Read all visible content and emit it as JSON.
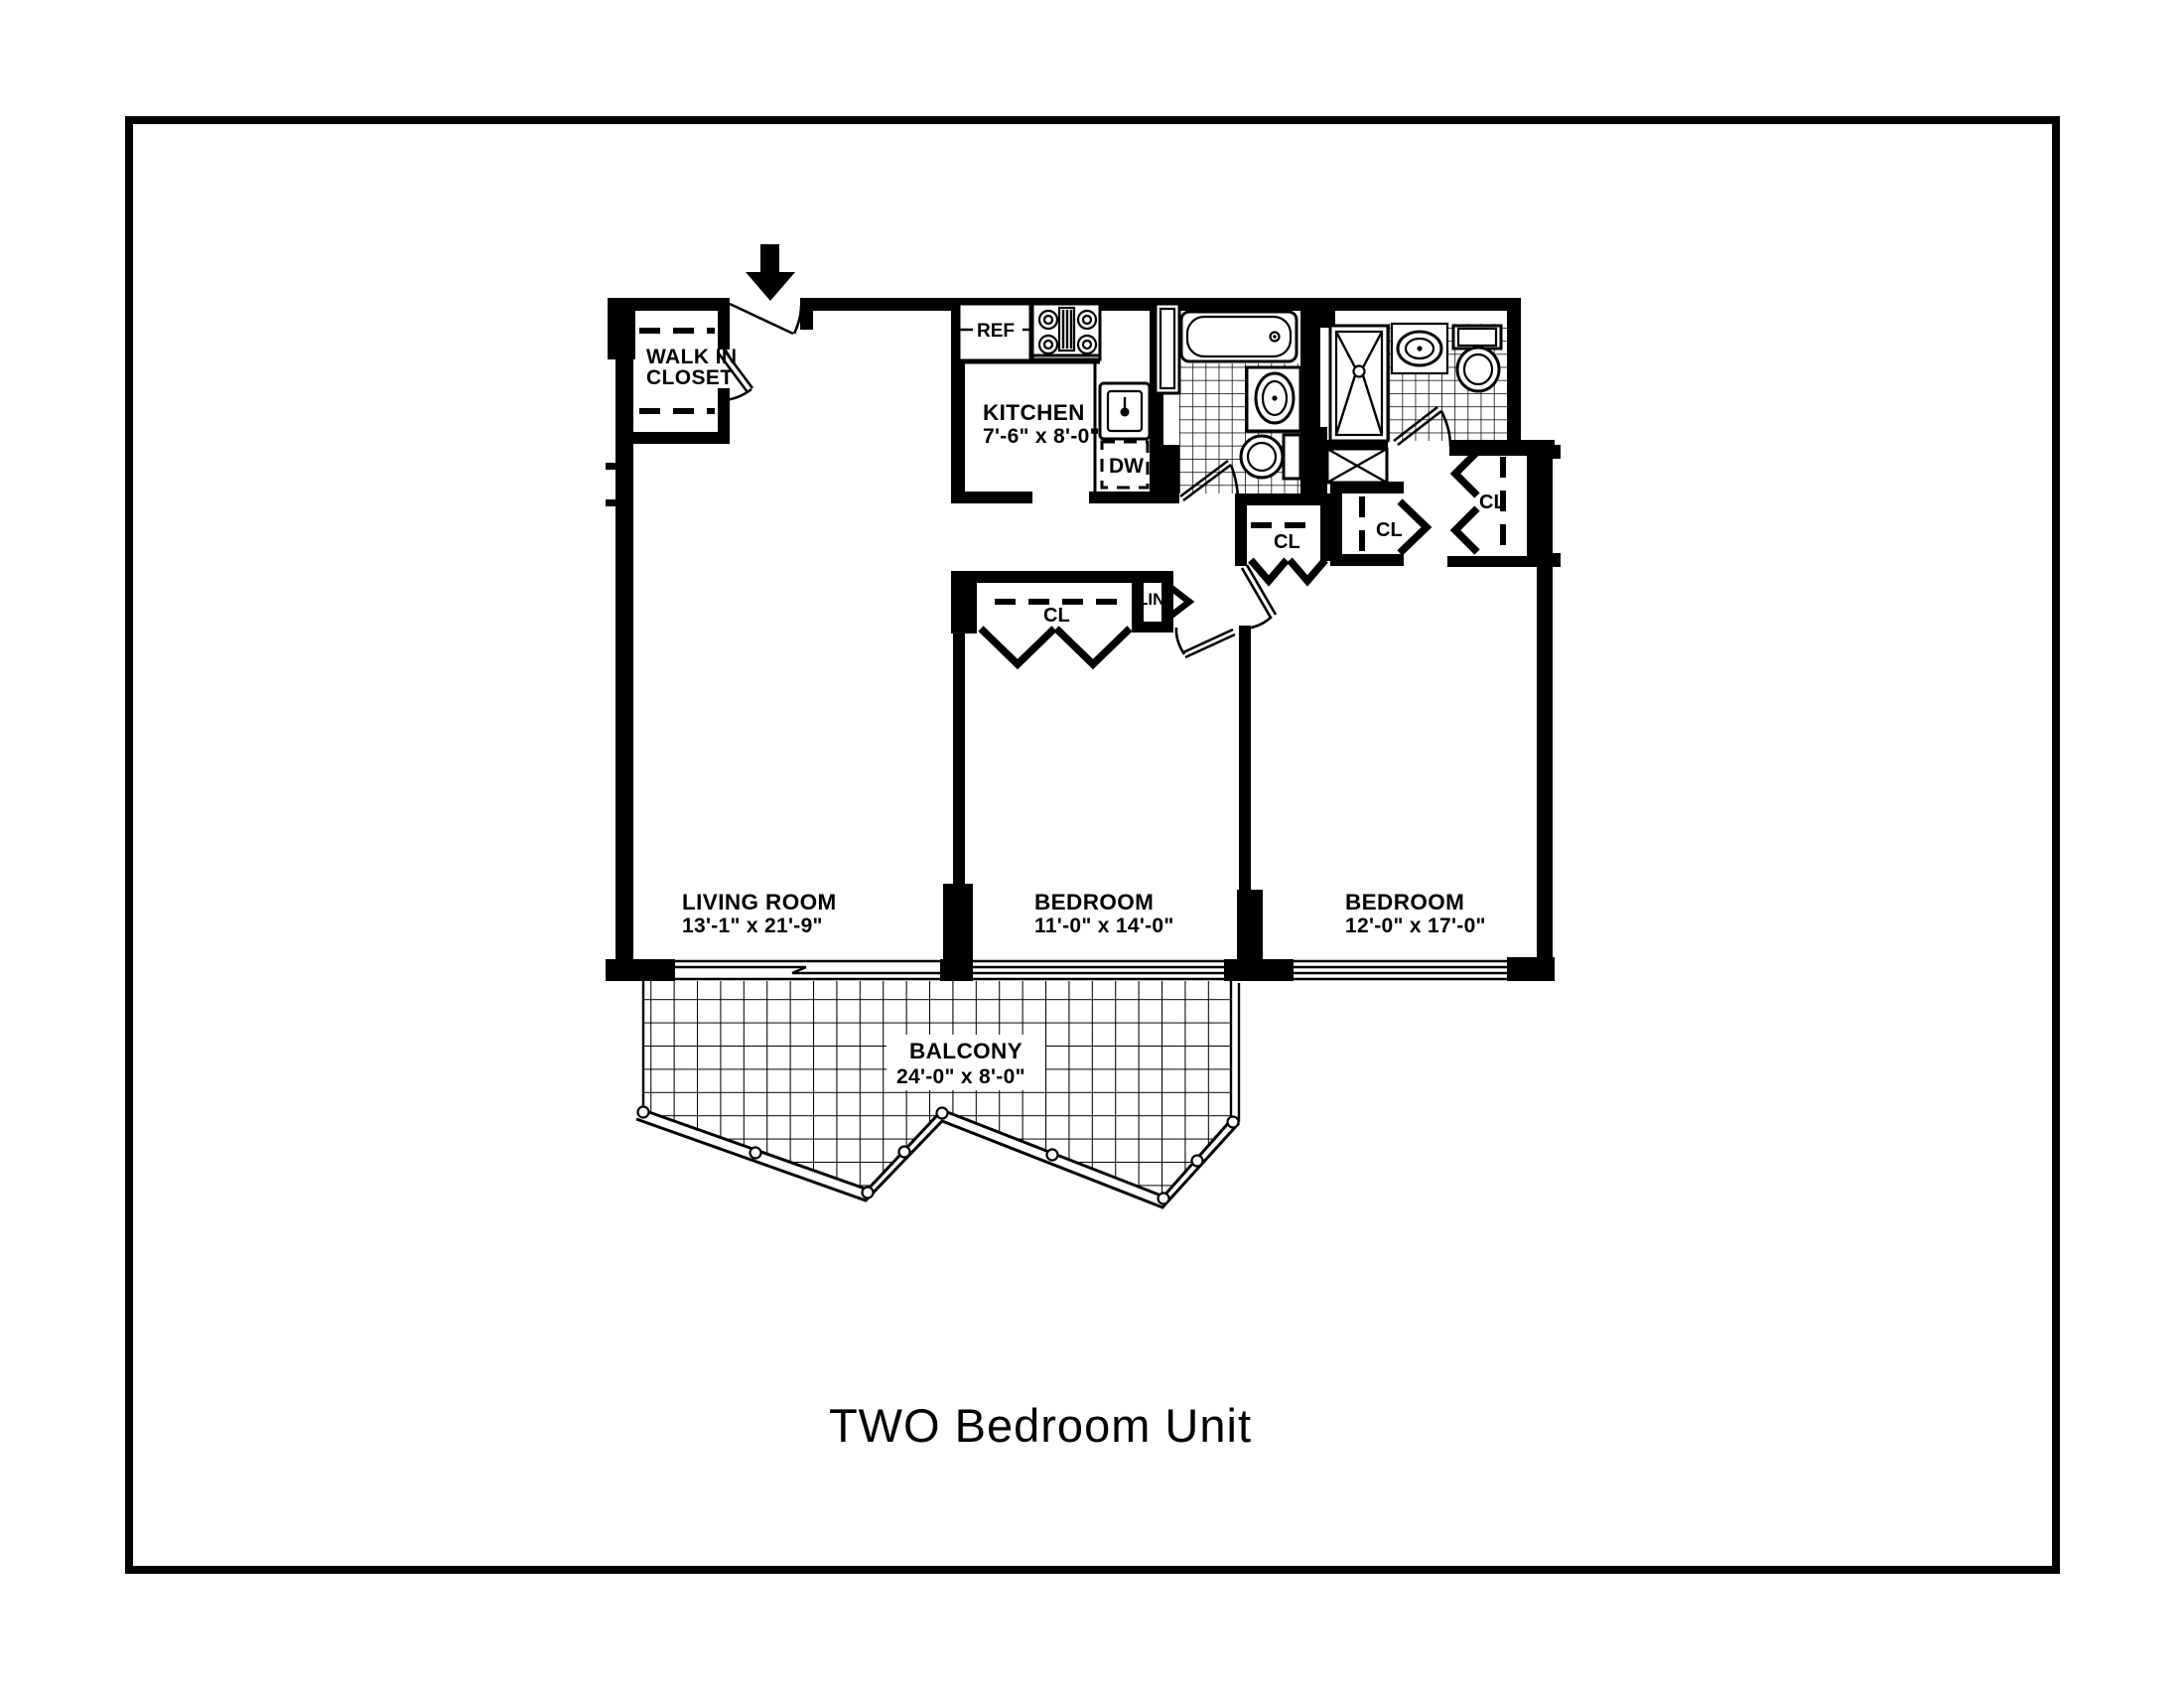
{
  "page": {
    "title": "TWO Bedroom Unit"
  },
  "plan": {
    "rooms": {
      "living_room": {
        "name": "LIVING ROOM",
        "dims": "13'-1\" x 21'-9\""
      },
      "bedroom_1": {
        "name": "BEDROOM",
        "dims": "11'-0\" x 14'-0\""
      },
      "bedroom_2": {
        "name": "BEDROOM",
        "dims": "12'-0\" x 17'-0\""
      },
      "kitchen": {
        "name": "KITCHEN",
        "dims": "7'-6\" x 8'-0\""
      },
      "balcony": {
        "name": "BALCONY",
        "dims": "24'-0\" x 8'-0\""
      },
      "walk_in_closet": {
        "line1": "WALK IN",
        "line2": "CLOSET"
      }
    },
    "labels": {
      "closet": "CL",
      "linen": "LIN.",
      "refrigerator": "REF",
      "dishwasher": "DW"
    }
  },
  "colors": {
    "ink": "#000000",
    "paper": "#ffffff"
  }
}
